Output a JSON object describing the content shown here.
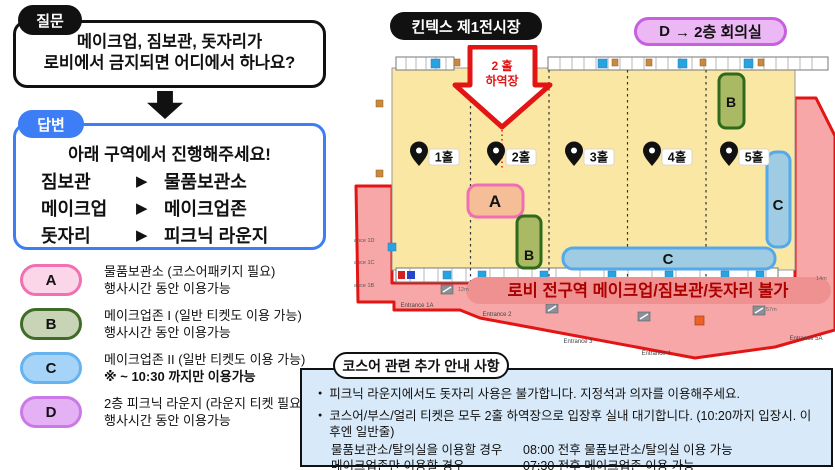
{
  "question": {
    "label": "질문",
    "line1": "메이크업, 짐보관, 돗자리가",
    "line2": "로비에서 금지되면 어디에서 하나요?"
  },
  "answer": {
    "label": "답변",
    "intro": "아래 구역에서 진행해주세요!",
    "pointer_glyph": "▶",
    "rows": [
      {
        "term": "짐보관",
        "dest": "물품보관소"
      },
      {
        "term": "메이크업",
        "dest": "메이크업존"
      },
      {
        "term": "돗자리",
        "dest": "피크닉 라운지"
      }
    ]
  },
  "legend": {
    "items": [
      {
        "key": "A",
        "line1": "물품보관소 (코스어패키지 필요)",
        "line2": "행사시간 동안 이용가능",
        "fill": "#FBD5E8",
        "border": "#F170B2"
      },
      {
        "key": "B",
        "line1": "메이크업존 I (일반 티켓도 이용 가능)",
        "line2": "행사시간 동안 이용가능",
        "fill": "#C7D4B5",
        "border": "#3F6C27"
      },
      {
        "key": "C",
        "line1": "메이크업존 II (일반 티켓도 이용 가능)",
        "line2": "※ ~ 10:30 까지만 이용가능",
        "fill": "#A6D4F8",
        "border": "#66B3F0"
      },
      {
        "key": "D",
        "line1": "2층 피크닉 라운지 (라운지 티켓 필요)",
        "line2": "행사시간 동안 이용가능",
        "fill": "#E4B1F4",
        "border": "#CB79E8"
      }
    ]
  },
  "map": {
    "title": "킨텍스 제1전시장",
    "d_room": {
      "badge": "D",
      "rest": "→ 2층 회의실"
    },
    "loading_arrow": {
      "line1": "2 홀",
      "line2": "하역장"
    },
    "halls": [
      {
        "label": "1홀"
      },
      {
        "label": "2홀"
      },
      {
        "label": "3홀"
      },
      {
        "label": "4홀"
      },
      {
        "label": "5홀"
      }
    ],
    "zones": [
      {
        "letter": "A"
      },
      {
        "letter": "B"
      },
      {
        "letter": "B"
      },
      {
        "letter": "C"
      },
      {
        "letter": "C"
      }
    ],
    "ban_banner": "로비 전구역 메이크업/짐보관/돗자리 불가",
    "entrances": [
      "Entrance 1A",
      "Entrance 2",
      "Entrance 3",
      "Entrance 4",
      "Entrance 5A"
    ],
    "side_entrances": [
      "ance 1D",
      "ance 1C",
      "ance 1B"
    ],
    "distance_labels": [
      "12m",
      "57m",
      "14m"
    ]
  },
  "notice": {
    "title": "코스어 관련 추가 안내 사항",
    "bullet1": "피크닉 라운지에서도 돗자리 사용은 불가합니다. 지정석과 의자를 이용해주세요.",
    "bullet2": "코스어/부스/얼리 티켓은 모두 2홀 하역장으로 입장후 실내 대기합니다. (10:20까지 입장시. 이후엔 일반줄)",
    "rows": [
      {
        "label": "물품보관소/탈의실을 이용할 경우",
        "value": "08:00 전후 물품보관소/탈의실 이용 가능"
      },
      {
        "label": "메이크업존만 이용할 경우",
        "value": "07:30 전후 메이크업존 이용 가능"
      }
    ],
    "footnote": "※ 상세 시간은 현장 상황에 따라 일부 상이할 수 있습니다."
  },
  "colors": {
    "accent_blue": "#3D7DF5",
    "hall_yellow": "#FAE7A3",
    "lobby_red_fill": "#F7A7A7",
    "lobby_red_border": "#E21414",
    "banner_text_red": "#AC0000",
    "zone_a_fill": "#F6BE96",
    "zone_a_border": "#F06EB4",
    "zone_b_fill": "#A9B964",
    "zone_b_border": "#2F6A1C",
    "zone_c_fill": "#9FCBE3",
    "zone_c_border": "#54A9E8",
    "d_room_fill": "#EBB7F5",
    "d_room_border": "#C75FDE",
    "notice_bg": "#D8EAF9"
  }
}
